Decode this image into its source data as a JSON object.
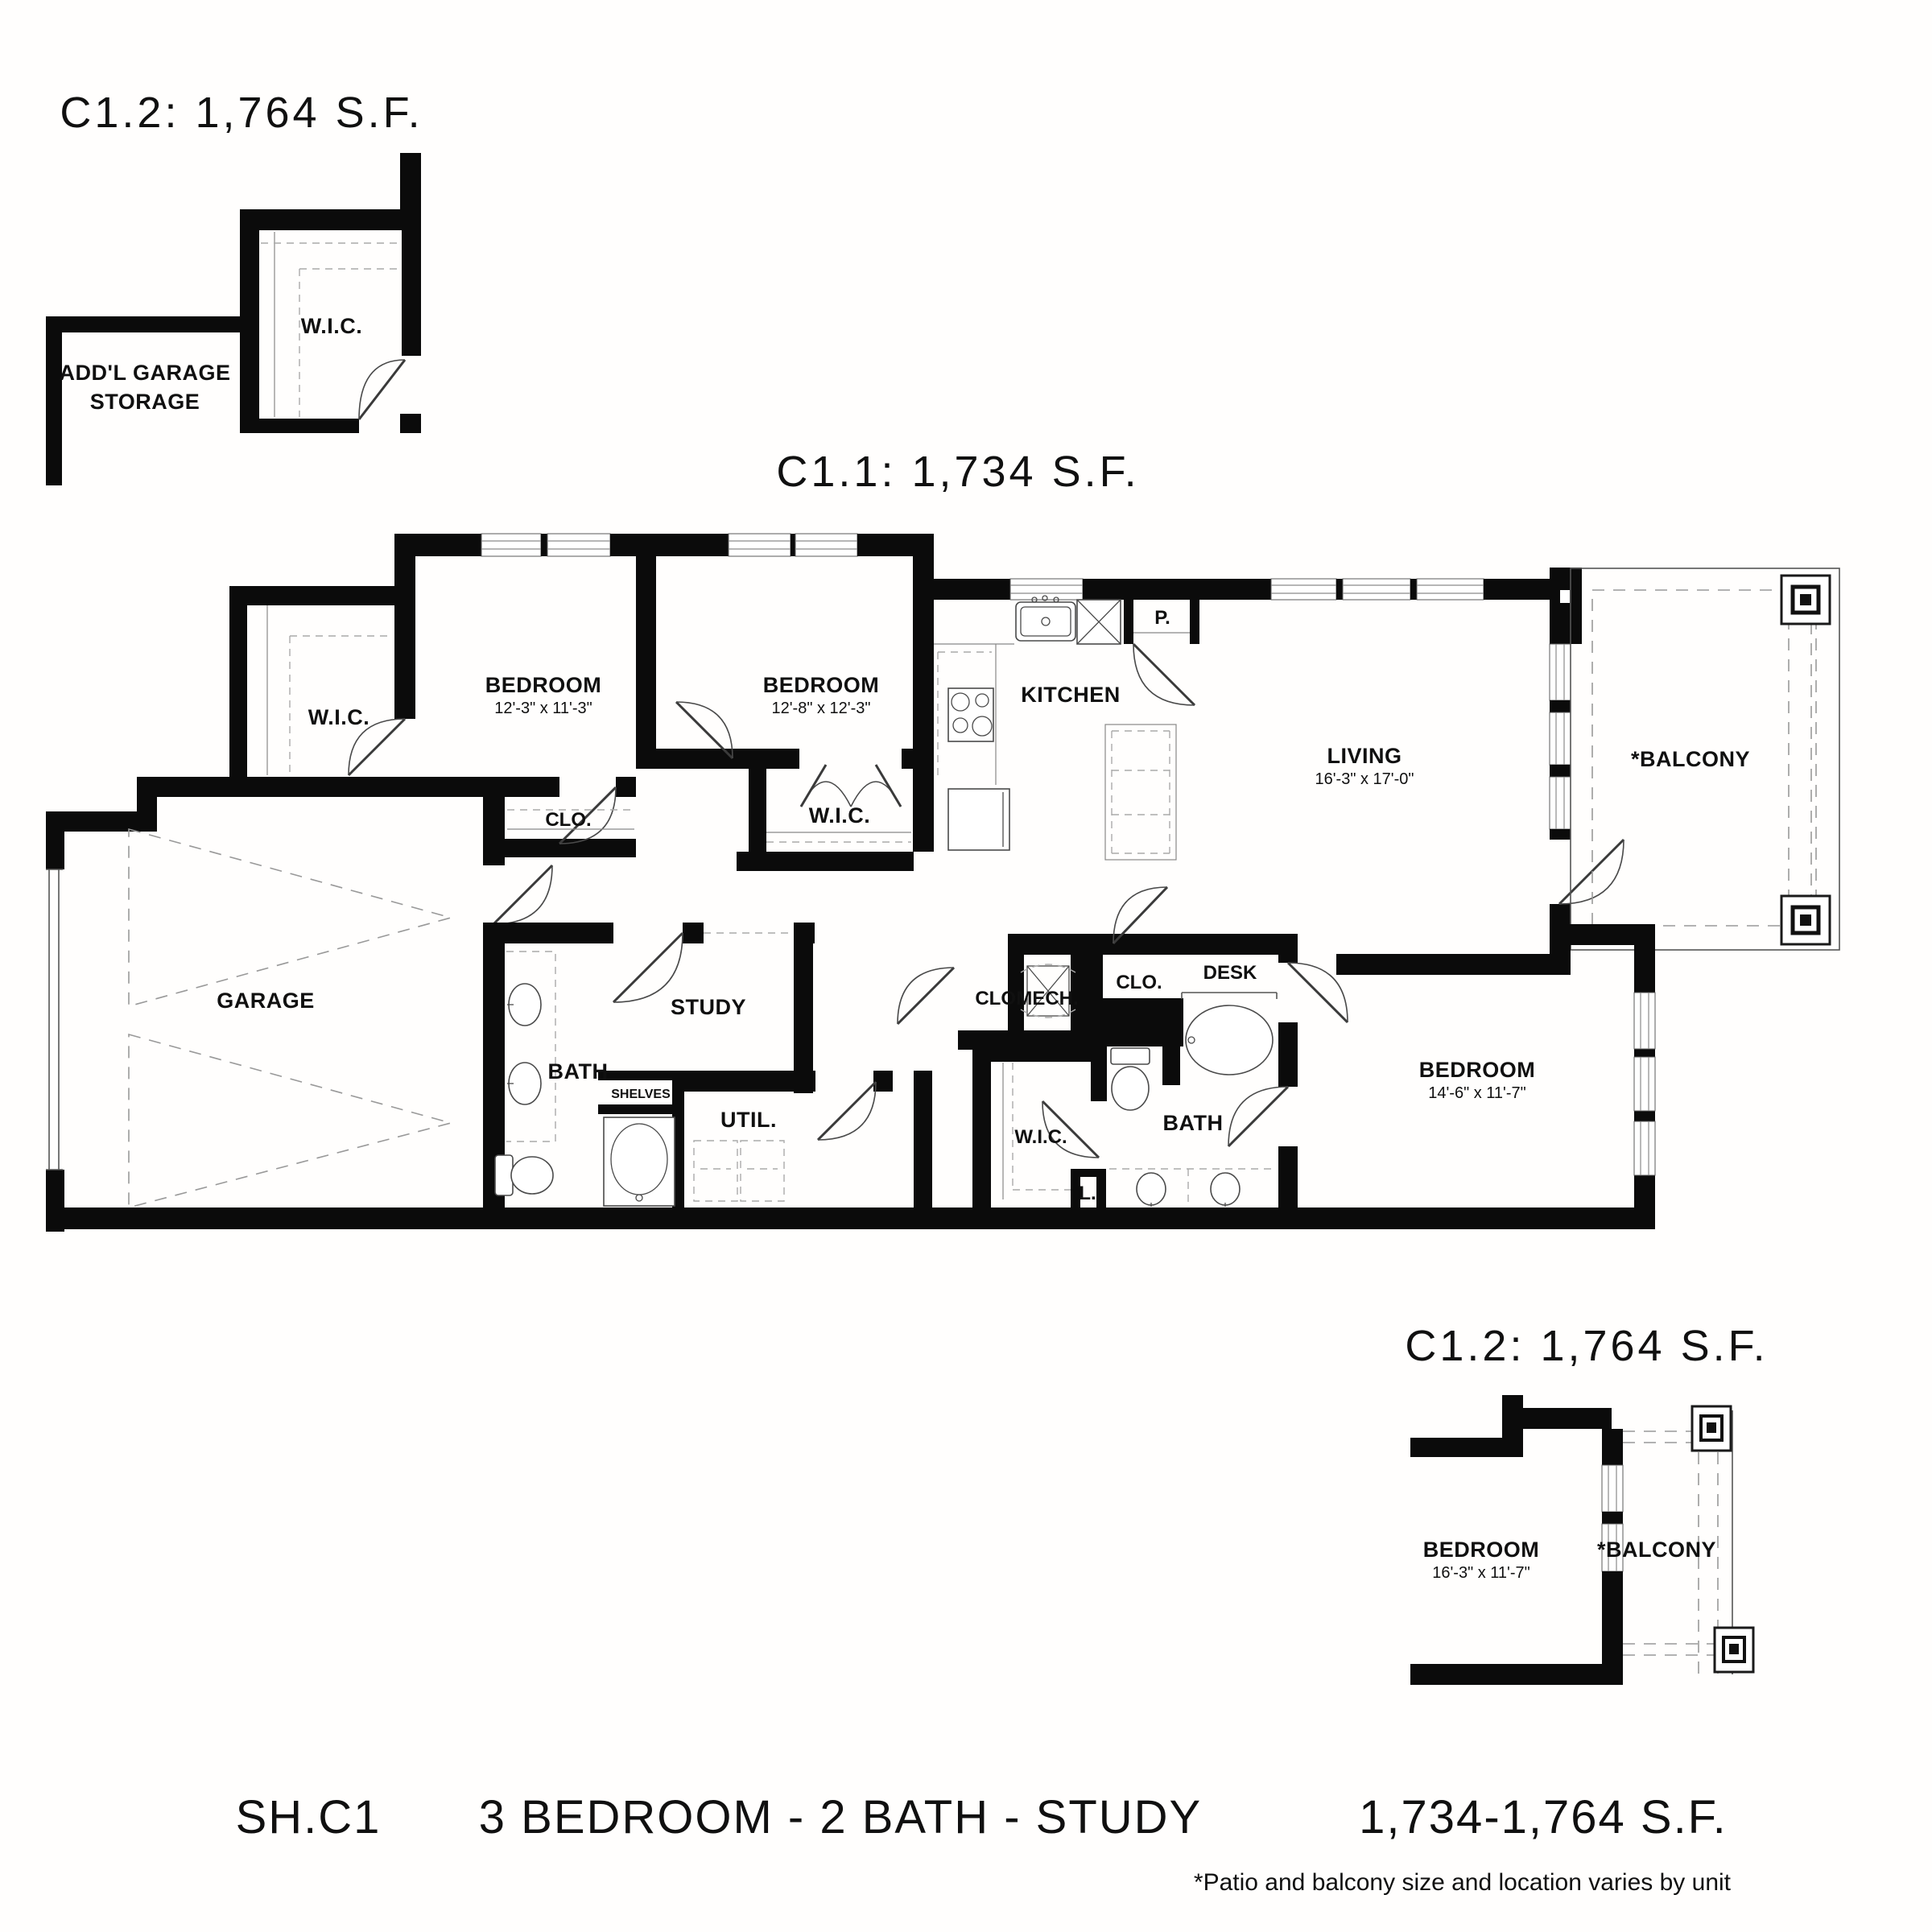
{
  "page": {
    "background": "#ffffff",
    "line_color": "#0b0b0b"
  },
  "titles": {
    "variant_top": "C1.2: 1,764 S.F.",
    "variant_main": "C1.1: 1,734 S.F.",
    "variant_bottom": "C1.2: 1,764 S.F."
  },
  "footer": {
    "plan_code": "SH.C1",
    "description": "3 BEDROOM - 2 BATH - STUDY",
    "size_range": "1,734-1,764 S.F.",
    "note": "*Patio and balcony size and location varies by unit"
  },
  "inset_top_left": {
    "storage_line1": "ADD'L GARAGE",
    "storage_line2": "STORAGE",
    "wic": "W.I.C."
  },
  "main_plan": {
    "wic1": "W.I.C.",
    "bedroom1": {
      "name": "BEDROOM",
      "dims": "12'-3\" x 11'-3\""
    },
    "bedroom2": {
      "name": "BEDROOM",
      "dims": "12'-8\" x 12'-3\""
    },
    "kitchen": "KITCHEN",
    "pantry": "P.",
    "living": {
      "name": "LIVING",
      "dims": "16'-3\" x 17'-0\""
    },
    "balcony": "*BALCONY",
    "garage": "GARAGE",
    "closet1": "CLO.",
    "wic2": "W.I.C.",
    "bath1": "BATH",
    "study": "STUDY",
    "shelves": "SHELVES",
    "utility": "UTIL.",
    "closet2": "CLO.",
    "mech": "MECH.",
    "closet3": "CLO.",
    "desk": "DESK",
    "wic3": "W.I.C.",
    "bath2": "BATH",
    "linen": "L.",
    "bedroom3": {
      "name": "BEDROOM",
      "dims": "14'-6\" x 11'-7\""
    }
  },
  "inset_bottom_right": {
    "bedroom": {
      "name": "BEDROOM",
      "dims": "16'-3\" x 11'-7\""
    },
    "balcony": "*BALCONY"
  }
}
